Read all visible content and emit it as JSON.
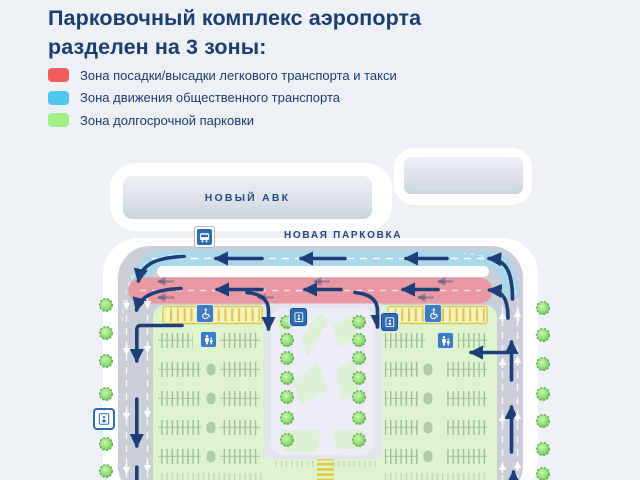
{
  "header": {
    "title_line1": "Парковочный комплекс аэропорта",
    "title_line2": "разделен на 3 зоны:"
  },
  "legend": {
    "items": [
      {
        "label": "Зона посадки/высадки легкового транспорта и такси",
        "color": "#ef5e5e"
      },
      {
        "label": "Зона движения общественного транспорта",
        "color": "#50c5ee"
      },
      {
        "label": "Зона долгосрочной парковки",
        "color": "#a5ef89"
      }
    ]
  },
  "map": {
    "terminal_building_label": "НОВЫЙ АВК",
    "parking_area_label": "НОВАЯ ПАРКОВКА",
    "zone_colors": {
      "dropoff_taxi_zone": "#e899a3",
      "public_transport_zone": "#a9d8eb",
      "longterm_parking_zone": "#def4cd"
    },
    "road_color": "#c9ced9",
    "arrow_color": "#1e3e78",
    "icons": {
      "bus_stop": "bus-stop-icon",
      "accessible_parking": "wheelchair-icon",
      "family_parking": "family-with-child-icon",
      "elevator": "elevator-icon",
      "tree": "tree-icon"
    }
  }
}
